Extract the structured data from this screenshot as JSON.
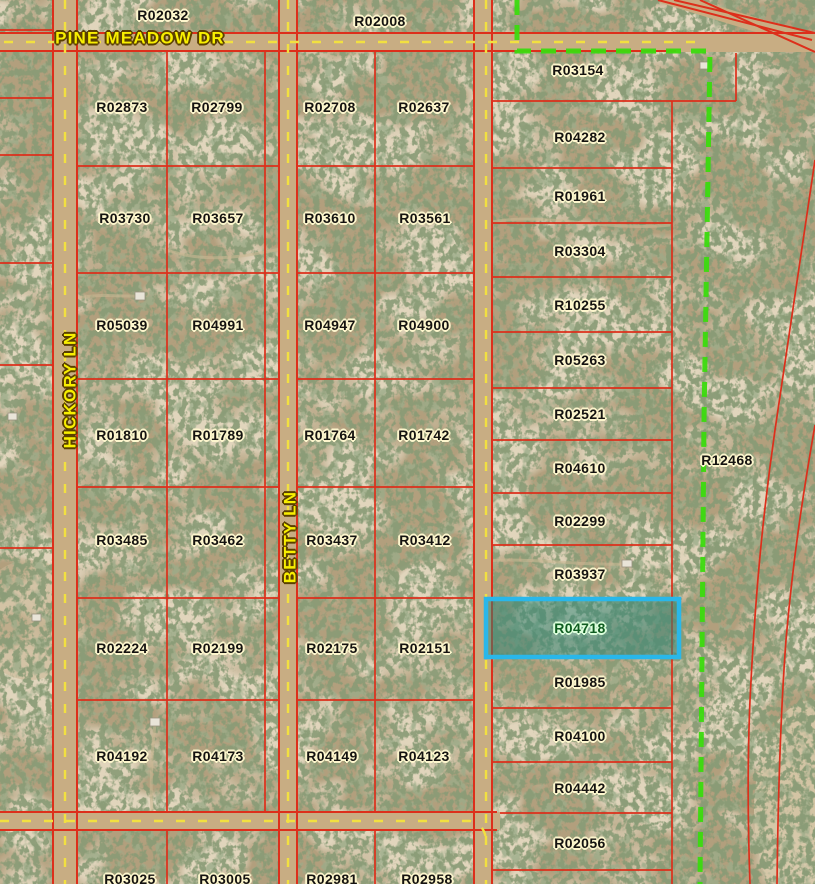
{
  "colors": {
    "terrain": "#b29f7d",
    "tree": "#42552f",
    "parcel_line": "#dd2f1b",
    "road_surface": "#c8ad83",
    "road_centerline": "#f2e040",
    "road_label": "#f8ef00",
    "parcel_label_text": "#141210",
    "parcel_label_halo": "#fdf6cd",
    "subdivision_boundary": "#3bdb0e",
    "highlight_border": "#29b7ea",
    "highlight_fill": "rgba(42,132,118,0.5)",
    "highlight_label_text": "#0e5c20",
    "highlight_label_halo": "#dcffdc"
  },
  "roads": {
    "horizontal_top": {
      "label": "PINE MEADOW DR"
    },
    "vertical_left": {
      "label": "HICKORY LN"
    },
    "vertical_middle": {
      "label": "BETTY LN"
    }
  },
  "selected_parcel": {
    "id": "R04718"
  },
  "parcel_labels": [
    {
      "id": "R02032",
      "x": 163,
      "y": 15
    },
    {
      "id": "R02008",
      "x": 380,
      "y": 21
    },
    {
      "id": "R02873",
      "x": 122,
      "y": 107
    },
    {
      "id": "R02799",
      "x": 217,
      "y": 107
    },
    {
      "id": "R02708",
      "x": 330,
      "y": 107
    },
    {
      "id": "R02637",
      "x": 424,
      "y": 107
    },
    {
      "id": "R03730",
      "x": 125,
      "y": 218
    },
    {
      "id": "R03657",
      "x": 218,
      "y": 218
    },
    {
      "id": "R03610",
      "x": 330,
      "y": 218
    },
    {
      "id": "R03561",
      "x": 425,
      "y": 218
    },
    {
      "id": "R05039",
      "x": 122,
      "y": 325
    },
    {
      "id": "R04991",
      "x": 218,
      "y": 325
    },
    {
      "id": "R04947",
      "x": 330,
      "y": 325
    },
    {
      "id": "R04900",
      "x": 424,
      "y": 325
    },
    {
      "id": "R01810",
      "x": 122,
      "y": 435
    },
    {
      "id": "R01789",
      "x": 218,
      "y": 435
    },
    {
      "id": "R01764",
      "x": 330,
      "y": 435
    },
    {
      "id": "R01742",
      "x": 424,
      "y": 435
    },
    {
      "id": "R03485",
      "x": 122,
      "y": 540
    },
    {
      "id": "R03462",
      "x": 218,
      "y": 540
    },
    {
      "id": "R03437",
      "x": 332,
      "y": 540
    },
    {
      "id": "R03412",
      "x": 425,
      "y": 540
    },
    {
      "id": "R02224",
      "x": 122,
      "y": 648
    },
    {
      "id": "R02199",
      "x": 218,
      "y": 648
    },
    {
      "id": "R02175",
      "x": 332,
      "y": 648
    },
    {
      "id": "R02151",
      "x": 425,
      "y": 648
    },
    {
      "id": "R04192",
      "x": 122,
      "y": 756
    },
    {
      "id": "R04173",
      "x": 218,
      "y": 756
    },
    {
      "id": "R04149",
      "x": 332,
      "y": 756
    },
    {
      "id": "R04123",
      "x": 424,
      "y": 756
    },
    {
      "id": "R03025",
      "x": 130,
      "y": 879
    },
    {
      "id": "R03005",
      "x": 225,
      "y": 879
    },
    {
      "id": "R02981",
      "x": 332,
      "y": 879
    },
    {
      "id": "R02958",
      "x": 427,
      "y": 879
    },
    {
      "id": "R03154",
      "x": 578,
      "y": 70
    },
    {
      "id": "R04282",
      "x": 580,
      "y": 137
    },
    {
      "id": "R01961",
      "x": 580,
      "y": 196
    },
    {
      "id": "R03304",
      "x": 580,
      "y": 251
    },
    {
      "id": "R10255",
      "x": 580,
      "y": 305
    },
    {
      "id": "R05263",
      "x": 580,
      "y": 360
    },
    {
      "id": "R02521",
      "x": 580,
      "y": 414
    },
    {
      "id": "R04610",
      "x": 580,
      "y": 468
    },
    {
      "id": "R02299",
      "x": 580,
      "y": 521
    },
    {
      "id": "R03937",
      "x": 580,
      "y": 574
    },
    {
      "id": "R04718",
      "x": 580,
      "y": 628
    },
    {
      "id": "R01985",
      "x": 580,
      "y": 682
    },
    {
      "id": "R04100",
      "x": 580,
      "y": 736
    },
    {
      "id": "R04442",
      "x": 580,
      "y": 788
    },
    {
      "id": "R02056",
      "x": 580,
      "y": 843
    },
    {
      "id": "R12468",
      "x": 727,
      "y": 460
    }
  ]
}
